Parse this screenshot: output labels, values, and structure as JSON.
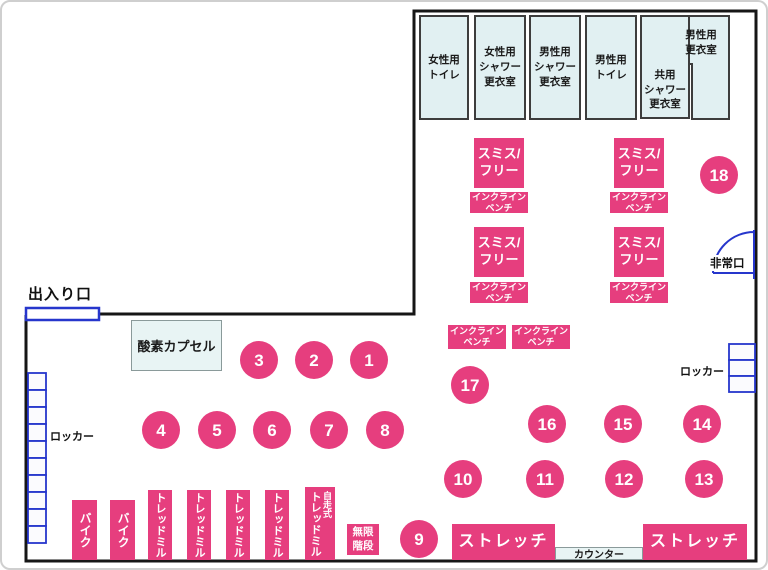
{
  "labels": {
    "entrance": "出入り口",
    "emergency_exit": "非常口",
    "locker": "ロッカー"
  },
  "rooms": {
    "womens_toilet": "女性用\nトイレ",
    "womens_shower": "女性用\nシャワー\n更衣室",
    "mens_shower": "男性用\nシャワー\n更衣室",
    "mens_toilet": "男性用\nトイレ",
    "shared_shower": "共用\nシャワー\n更衣室",
    "mens_locker_room": "男性用\n更衣室"
  },
  "machines": {
    "oxygen_capsule": "酸素カプセル",
    "smith_free": "スミス/\nフリー",
    "incline_bench": "インクライン\nベンチ",
    "bike": "バイク",
    "treadmill": "トレッドミル",
    "self_propelled": "自走式",
    "infinite_stairs": "無限\n階段",
    "stretch": "ストレッチ",
    "counter": "カウンター"
  },
  "station_numbers": [
    "1",
    "2",
    "3",
    "4",
    "5",
    "6",
    "7",
    "8",
    "9",
    "10",
    "11",
    "12",
    "13",
    "14",
    "15",
    "16",
    "17",
    "18"
  ],
  "colors": {
    "pink": "#e63e7e",
    "room_fill": "#e1f0f2",
    "door_blue": "#2636cc",
    "wall": "#161616",
    "counter_fill": "#e8f4f4"
  }
}
